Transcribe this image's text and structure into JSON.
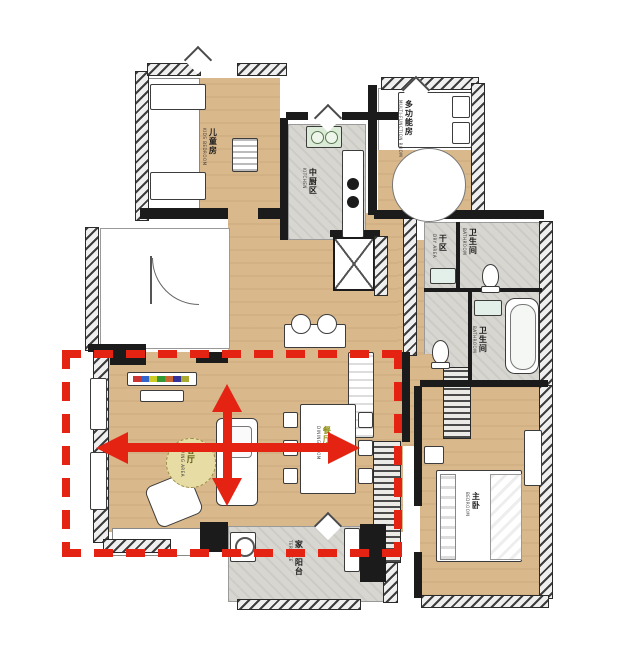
{
  "title": "apartment-floor-plan-with-living-dining-highlight",
  "rooms": {
    "kids": {
      "cn": "儿童房",
      "en": "KIDS BEDROOM"
    },
    "kitchen": {
      "cn": "中厨区",
      "en": "KITCHEN"
    },
    "multi": {
      "cn": "多功能房",
      "en": "MULTI-FUNCTION ROOM"
    },
    "dry": {
      "cn": "干区",
      "en": "DRY AREA"
    },
    "bath1": {
      "cn": "卫生间",
      "en": "BATHROOM"
    },
    "bath2": {
      "cn": "卫生间",
      "en": "BATHROOM"
    },
    "living": {
      "cn": "客厅",
      "en": "LIVING AREA"
    },
    "dining": {
      "cn": "餐厅",
      "en": "DINING ROOM"
    },
    "master": {
      "cn": "主卧",
      "en": "BEDROOM"
    },
    "balcony": {
      "cn": "家政阳台",
      "en": "TERRACE"
    }
  },
  "annotations": {
    "highlight_color": "#e42313",
    "dashed_box_meaning": "living-and-dining-zone-highlight",
    "arrow_horizontal": "zone-width-span",
    "arrow_vertical": "zone-depth-span"
  },
  "palette": {
    "floor_wood": "#d9b88c",
    "floor_tile": "#d8d6d1",
    "wall": "#1b1b1b",
    "background": "#ffffff"
  }
}
